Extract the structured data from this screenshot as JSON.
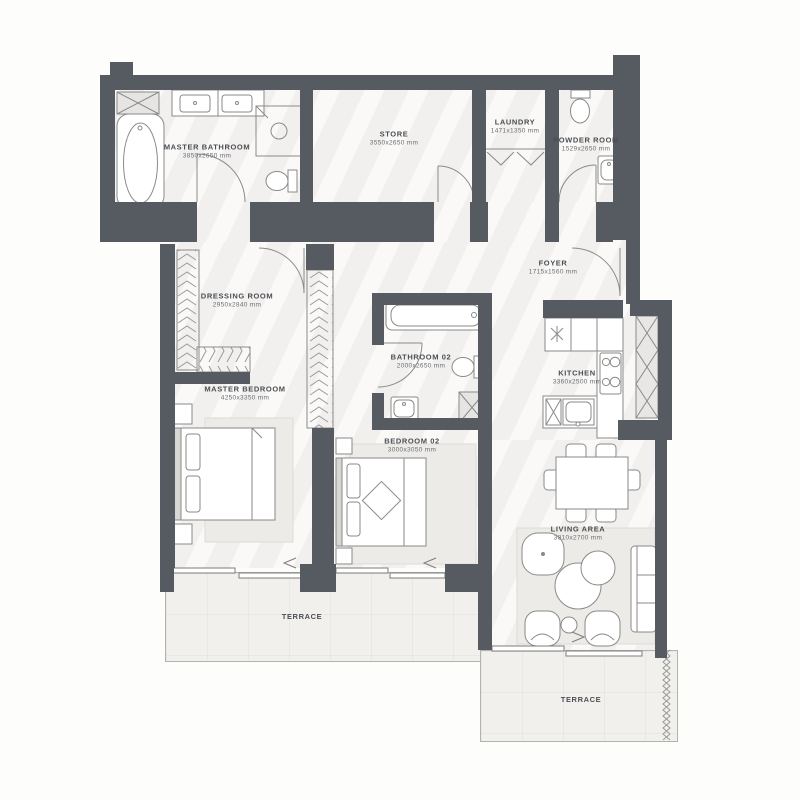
{
  "plan_type": "apartment-floor-plan",
  "rooms": [
    {
      "id": "master-bathroom",
      "label": "MASTER BATHROOM",
      "dims": "3850x2650 mm"
    },
    {
      "id": "store",
      "label": "STORE",
      "dims": "3550x2650 mm"
    },
    {
      "id": "laundry",
      "label": "LAUNDRY",
      "dims": "1471x1350 mm"
    },
    {
      "id": "powder-room",
      "label": "POWDER ROOM",
      "dims": "1529x2650 mm"
    },
    {
      "id": "dressing-room",
      "label": "DRESSING ROOM",
      "dims": "2950x2840 mm"
    },
    {
      "id": "foyer",
      "label": "FOYER",
      "dims": "1715x1560 mm"
    },
    {
      "id": "bathroom-02",
      "label": "BATHROOM 02",
      "dims": "2000x2650 mm"
    },
    {
      "id": "kitchen",
      "label": "KITCHEN",
      "dims": "3360x2500 mm"
    },
    {
      "id": "master-bedroom",
      "label": "MASTER BEDROOM",
      "dims": "4250x3350 mm"
    },
    {
      "id": "bedroom-02",
      "label": "BEDROOM 02",
      "dims": "3000x3050 mm"
    },
    {
      "id": "living-area",
      "label": "LIVING AREA",
      "dims": "3810x2700 mm"
    },
    {
      "id": "terrace-a",
      "label": "TERRACE",
      "dims": ""
    },
    {
      "id": "terrace-b",
      "label": "TERRACE",
      "dims": ""
    }
  ],
  "colors": {
    "wall": "#565b62",
    "floor": "#f4f3f1",
    "terrace": "#f1f0ed",
    "line": "#8a8a88",
    "ink": "#4b4e53",
    "ink2": "#6b6e72",
    "rug": "#edebe8"
  }
}
